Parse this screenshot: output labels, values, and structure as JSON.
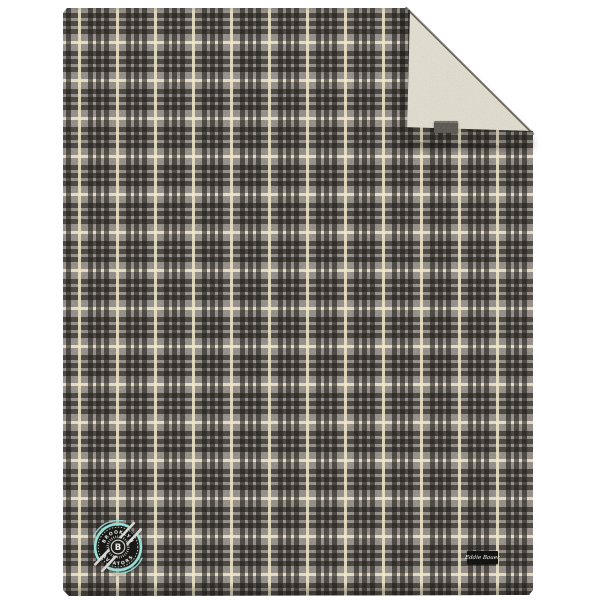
{
  "page": {
    "background": "#ffffff"
  },
  "product": {
    "description": "gray plaid blanket with sherpa lining, top-right corner folded over",
    "brand_label_text": "Eddie Bauer",
    "patch": {
      "top_text": "BROOKLYN",
      "bottom_text": "AVIATORS",
      "monogram": "B"
    },
    "colors": {
      "page_bg": "#ffffff",
      "plaid_base": "#8c8680",
      "plaid_dark": "rgba(30,27,23,0.62)",
      "plaid_cream": "rgba(240,230,198,0.85)",
      "sherpa": "#d9d4c5",
      "patch_teal": "#8edbd4",
      "patch_disc": "#161614",
      "patch_text": "#e3e3e0",
      "patch_stick": "#d4d2cc",
      "label_bg": "#121211",
      "label_text": "#f2f2ef",
      "tag_bg": "#57544e",
      "crease": "#4e4a44"
    }
  }
}
